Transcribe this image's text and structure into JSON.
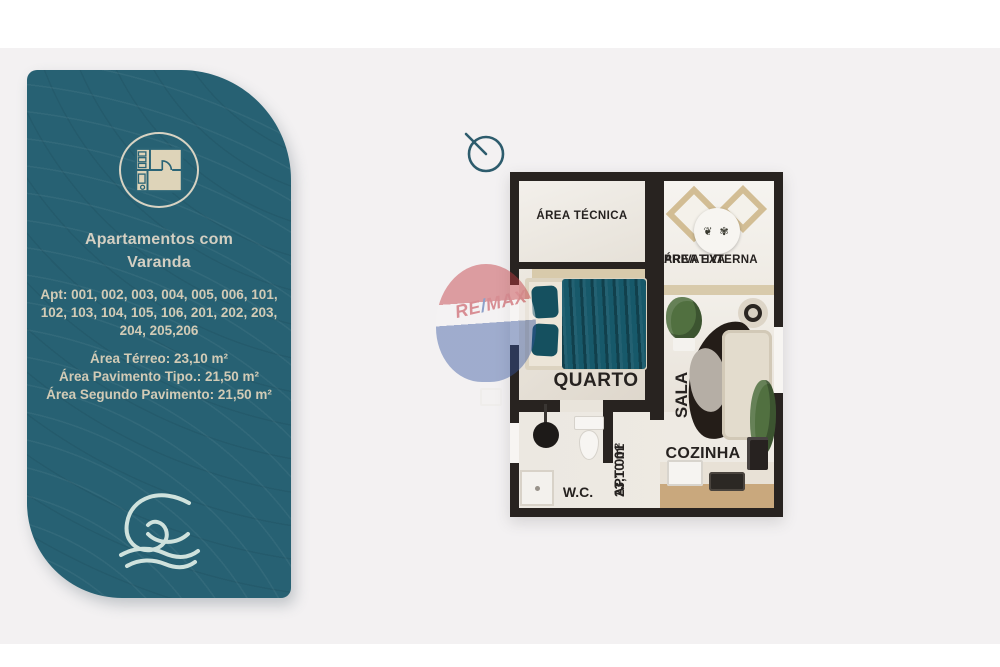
{
  "colors": {
    "background_main": "#f3f1f2",
    "background_bands": "#ffffff",
    "panel_teal": "#276173",
    "panel_text_cream": "#d2cbb6",
    "plan_wall": "#282320",
    "plan_floor": "#efece7",
    "accent_beige": "#d8caab",
    "bed_teal": "#17596a",
    "remax_red": "#c23f48",
    "remax_blue": "#3a5fa8"
  },
  "info_panel": {
    "title_lines": [
      "Apartamentos com",
      "Varanda"
    ],
    "apt_lines": [
      "Apt: 001, 002, 003, 004, 005, 006, 101,",
      "102, 103, 104, 105, 106, 201, 202, 203,",
      "204, 205,206"
    ],
    "area_lines": [
      "Área Térreo: 23,10 m²",
      "Área Pavimento Tipo.: 21,50 m²",
      "Área Segundo Pavimento: 21,50 m²"
    ]
  },
  "floor_plan": {
    "labels": {
      "area_tecnica": "ÁREA TÉCNICA",
      "area_externa_line1": "ÁREA EXTERNA",
      "area_externa_line2": "PRIVATIVA",
      "quarto": "QUARTO",
      "sala": "SALA",
      "cozinha": "COZINHA",
      "wc": "W.C.",
      "apt_tag": "APT 001",
      "apt_area": "23,10 m²"
    },
    "table_glyphs": "❦ ✾"
  },
  "watermark": {
    "re": "RE",
    "slash": "/",
    "max": "MAX"
  }
}
